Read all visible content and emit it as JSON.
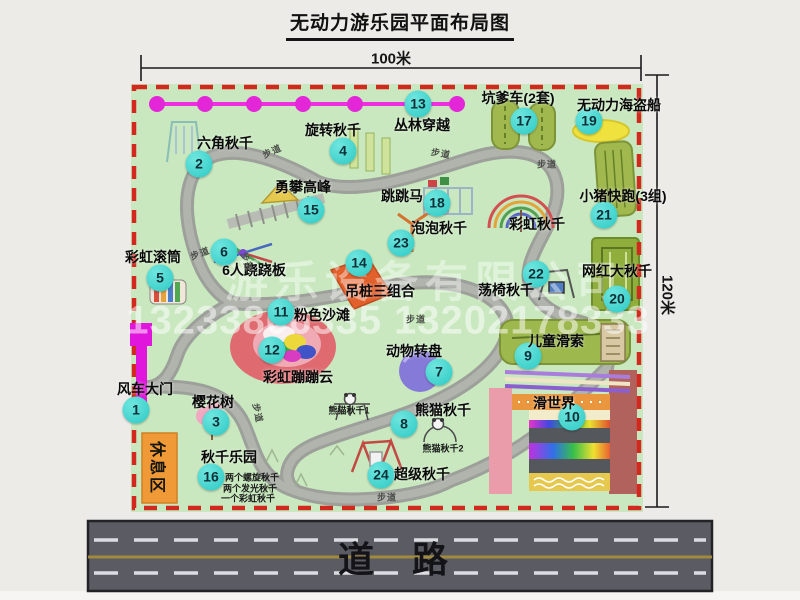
{
  "title": "无动力游乐园平面布局图",
  "dimensions": {
    "width_label": "100米",
    "height_label": "120米"
  },
  "road": {
    "label": "道 路"
  },
  "watermark": {
    "company": "游乐设备有限公司",
    "phone": "13233806335 13202178333"
  },
  "rest_area": {
    "label": "休息区"
  },
  "walkway": {
    "label": "步道",
    "positions": [
      {
        "x": 272,
        "y": 151,
        "r": -25
      },
      {
        "x": 441,
        "y": 153,
        "r": 10
      },
      {
        "x": 547,
        "y": 164,
        "r": 0
      },
      {
        "x": 200,
        "y": 253,
        "r": -20
      },
      {
        "x": 247,
        "y": 262,
        "r": 72
      },
      {
        "x": 416,
        "y": 319,
        "r": 0
      },
      {
        "x": 258,
        "y": 413,
        "r": 78
      },
      {
        "x": 387,
        "y": 497,
        "r": 0
      }
    ]
  },
  "attractions": [
    {
      "num": 1,
      "name": "风车大门",
      "bx": 136,
      "by": 410,
      "lx": 145,
      "ly": 389
    },
    {
      "num": 2,
      "name": "六角秋千",
      "bx": 199,
      "by": 164,
      "lx": 225,
      "ly": 143
    },
    {
      "num": 3,
      "name": "樱花树",
      "bx": 216,
      "by": 422,
      "lx": 213,
      "ly": 402
    },
    {
      "num": 4,
      "name": "旋转秋千",
      "bx": 343,
      "by": 151,
      "lx": 333,
      "ly": 130
    },
    {
      "num": 5,
      "name": "彩虹滚筒",
      "bx": 160,
      "by": 278,
      "lx": 153,
      "ly": 257
    },
    {
      "num": 6,
      "name": "6人跷跷板",
      "bx": 224,
      "by": 252,
      "lx": 254,
      "ly": 270
    },
    {
      "num": 7,
      "name": "动物转盘",
      "bx": 439,
      "by": 372,
      "lx": 414,
      "ly": 351
    },
    {
      "num": 8,
      "name": "熊猫秋千",
      "bx": 404,
      "by": 424,
      "lx": 443,
      "ly": 410
    },
    {
      "num": 9,
      "name": "儿童滑索",
      "bx": 528,
      "by": 356,
      "lx": 556,
      "ly": 341
    },
    {
      "num": 10,
      "name": "滑世界",
      "bx": 572,
      "by": 417,
      "lx": 554,
      "ly": 403
    },
    {
      "num": 11,
      "name": "粉色沙滩",
      "bx": 281,
      "by": 312,
      "lx": 322,
      "ly": 315
    },
    {
      "num": 12,
      "name": "彩虹蹦蹦云",
      "bx": 272,
      "by": 350,
      "lx": 298,
      "ly": 377
    },
    {
      "num": 13,
      "name": "丛林穿越",
      "bx": 418,
      "by": 104,
      "lx": 422,
      "ly": 125
    },
    {
      "num": 14,
      "name": "吊桩三组合",
      "bx": 359,
      "by": 263,
      "lx": 380,
      "ly": 291
    },
    {
      "num": 15,
      "name": "勇攀高峰",
      "bx": 311,
      "by": 210,
      "lx": 303,
      "ly": 187
    },
    {
      "num": 16,
      "name": "秋千乐园",
      "bx": 211,
      "by": 477,
      "lx": 229,
      "ly": 457
    },
    {
      "num": 17,
      "name": "坑爹车(2套)",
      "bx": 524,
      "by": 121,
      "lx": 518,
      "ly": 98
    },
    {
      "num": 18,
      "name": "跳跳马",
      "bx": 437,
      "by": 203,
      "lx": 402,
      "ly": 196
    },
    {
      "num": 19,
      "name": "无动力海盗船",
      "bx": 589,
      "by": 121,
      "lx": 619,
      "ly": 105
    },
    {
      "num": 20,
      "name": "网红大秋千",
      "bx": 617,
      "by": 299,
      "lx": 617,
      "ly": 271
    },
    {
      "num": 21,
      "name": "小猪快跑(3组)",
      "bx": 604,
      "by": 215,
      "lx": 623,
      "ly": 196
    },
    {
      "num": 22,
      "name": "荡椅秋千",
      "bx": 536,
      "by": 274,
      "lx": 506,
      "ly": 290
    },
    {
      "num": 23,
      "name": "泡泡秋千",
      "bx": 401,
      "by": 243,
      "lx": 439,
      "ly": 228
    },
    {
      "num": 24,
      "name": "超级秋千",
      "bx": 381,
      "by": 475,
      "lx": 422,
      "ly": 474
    }
  ],
  "plain_labels": [
    {
      "t": "彩虹秋千",
      "x": 537,
      "y": 224
    }
  ],
  "small_labels": [
    {
      "t": "熊猫秋千1",
      "x": 349,
      "y": 410
    },
    {
      "t": "熊猫秋千2",
      "x": 443,
      "y": 448
    },
    {
      "t": "两个螺旋秋千",
      "x": 252,
      "y": 477
    },
    {
      "t": "两个发光秋千",
      "x": 250,
      "y": 488
    },
    {
      "t": "一个彩虹秋千",
      "x": 248,
      "y": 498
    }
  ],
  "colors": {
    "map_bg": "#c9e8bf",
    "border_red": "#d2281e",
    "badge": "#2cc9c4",
    "gate_magenta": "#e016dc",
    "chain_pink": "#ee2ee0",
    "road_gray": "#5b5b63",
    "rest_orange": "#ef9a36"
  }
}
